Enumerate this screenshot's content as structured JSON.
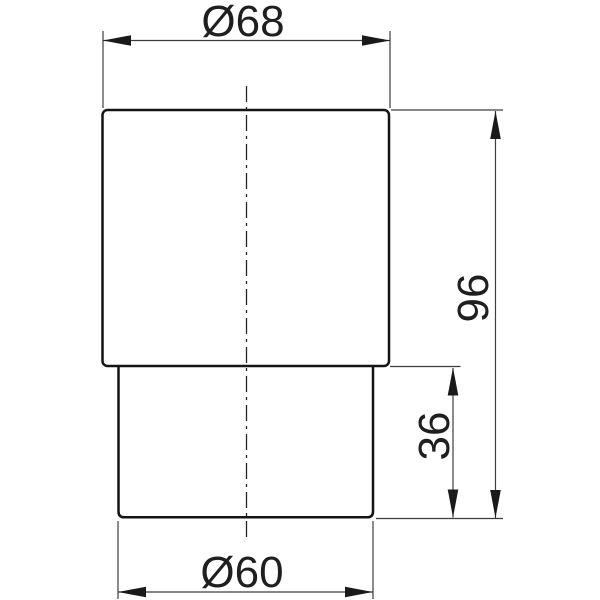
{
  "drawing": {
    "dimensions": {
      "top_diameter": {
        "label": "Ø68",
        "value": 68
      },
      "bottom_diameter": {
        "label": "Ø60",
        "value": 60
      },
      "overall_height": {
        "label": "96",
        "value": 96
      },
      "lower_section_height": {
        "label": "36",
        "value": 36
      }
    },
    "colors": {
      "background": "#ffffff",
      "outline": "#141414",
      "dimension_lines": "#3d3d3d",
      "centerline": "#262626",
      "arrow_fill": "#1a1a1a",
      "text": "#1f1f1f"
    }
  }
}
